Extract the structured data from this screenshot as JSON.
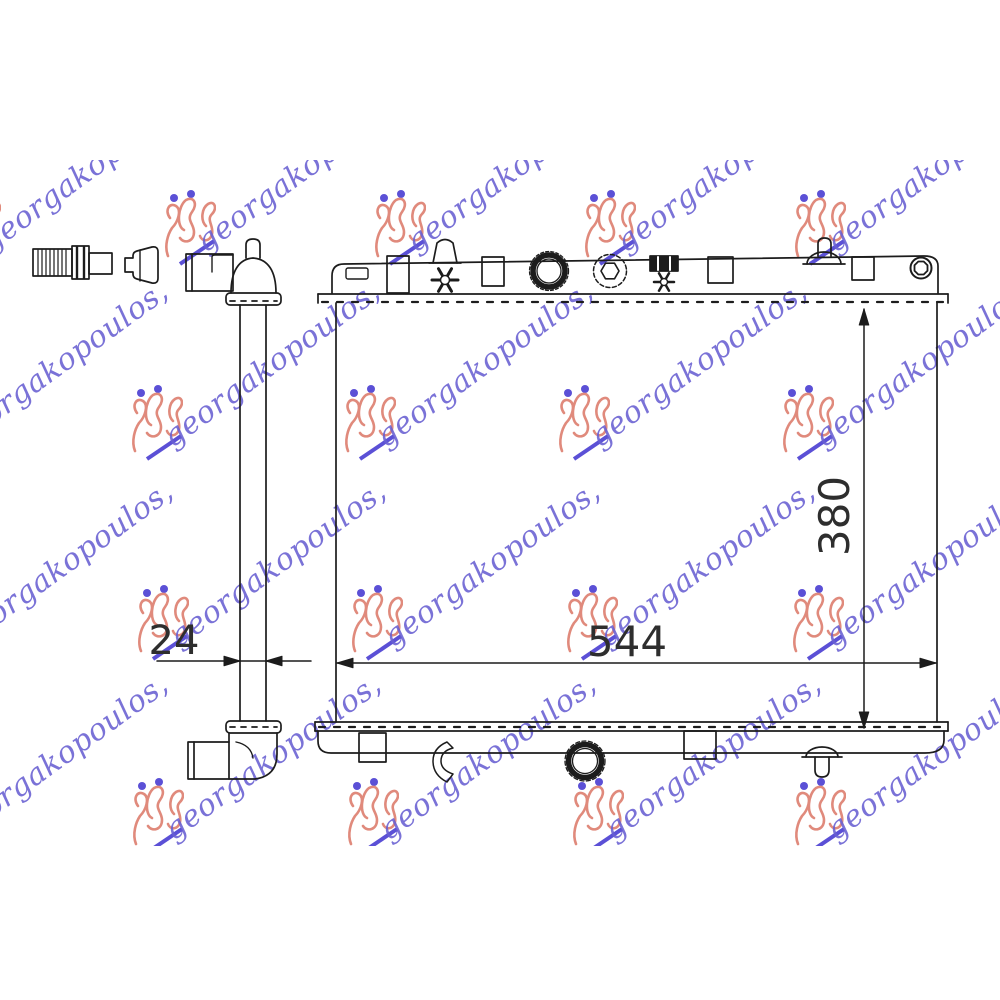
{
  "watermark": {
    "text": "georgakopoulos,",
    "text_color": "#685fd2",
    "logo_color": "#e08a7c",
    "accent_color": "#5b50d6"
  },
  "dimensions": {
    "core_width": "544",
    "core_height": "380",
    "core_depth": "24"
  }
}
